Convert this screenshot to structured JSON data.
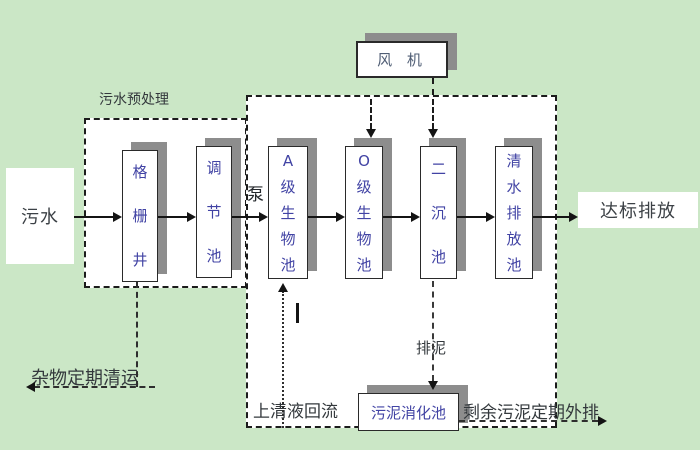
{
  "colors": {
    "background": "#cbe7c6",
    "box_fill": "#ffffff",
    "box_text": "#4143a4",
    "shadow": "#8d8d8d",
    "line": "#141414",
    "label_text": "#33383c"
  },
  "nodes": {
    "sewage": "污水",
    "grid_well": "格栅井",
    "regulating_tank": "调节池",
    "a_bio_tank": "A级生物池",
    "o_bio_tank": "O级生物池",
    "secondary_sedimentation_tank": "二沉池",
    "clean_water_discharge_tank": "清水排放池",
    "fan": "风 机",
    "sludge_digestion_tank": "污泥消化池",
    "standard_discharge": "达标排放"
  },
  "labels": {
    "pretreatment": "污水预处理",
    "pump": "泵",
    "debris_removal": "杂物定期清运",
    "supernatant_reflux": "上清液回流",
    "sludge_discharge": "排泥",
    "excess_sludge_out": "剩余污泥定期外排"
  }
}
